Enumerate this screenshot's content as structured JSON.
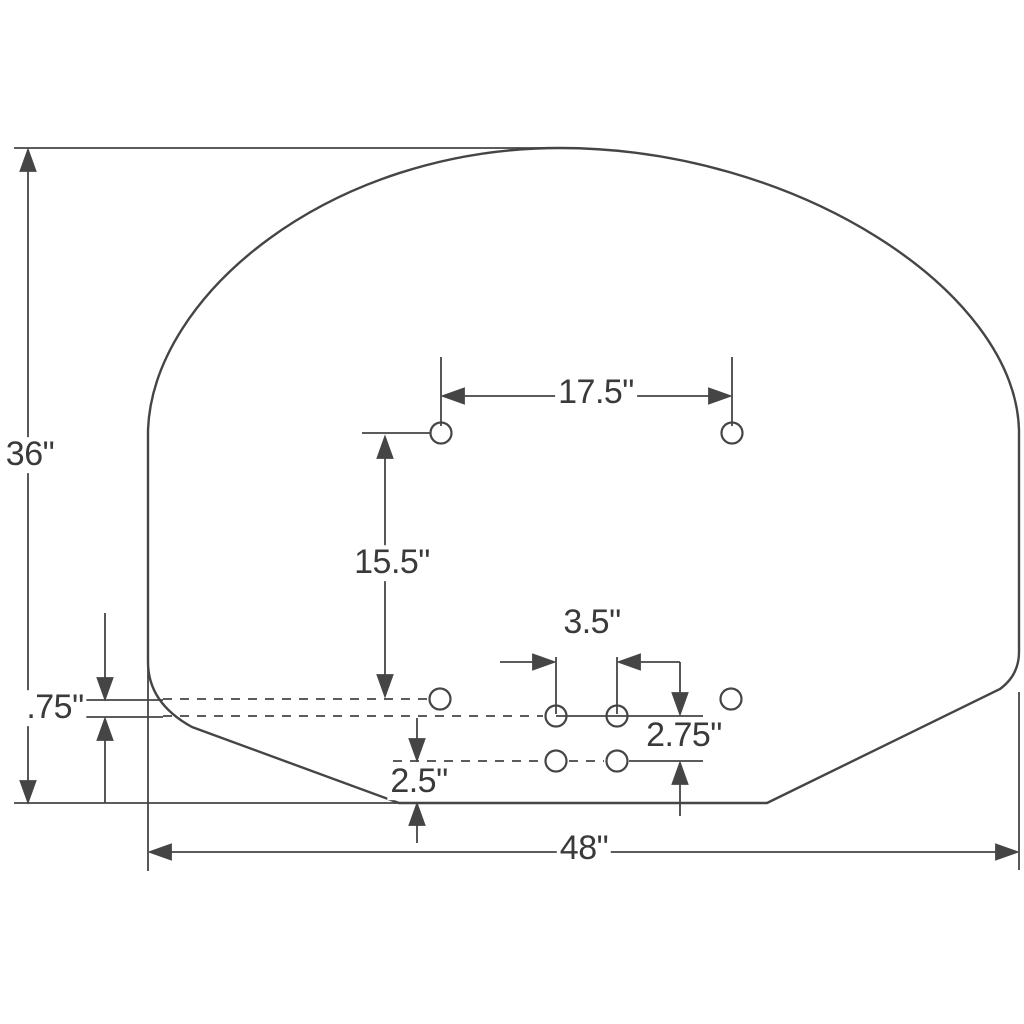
{
  "diagram": {
    "dimensions": {
      "overall_height": "36\"",
      "overall_width": "48\"",
      "top_hole_spacing": "17.5\"",
      "top_to_lower_hole_spacing": "15.5\"",
      "lower_hole_spacing": "3.5\"",
      "row_gap_small": ".75\"",
      "row_gap_mid": "2.75\"",
      "bottom_edge_gap": "2.5\""
    },
    "colors": {
      "line": "#454545",
      "text": "#3a3a3a",
      "background": "#ffffff"
    }
  }
}
